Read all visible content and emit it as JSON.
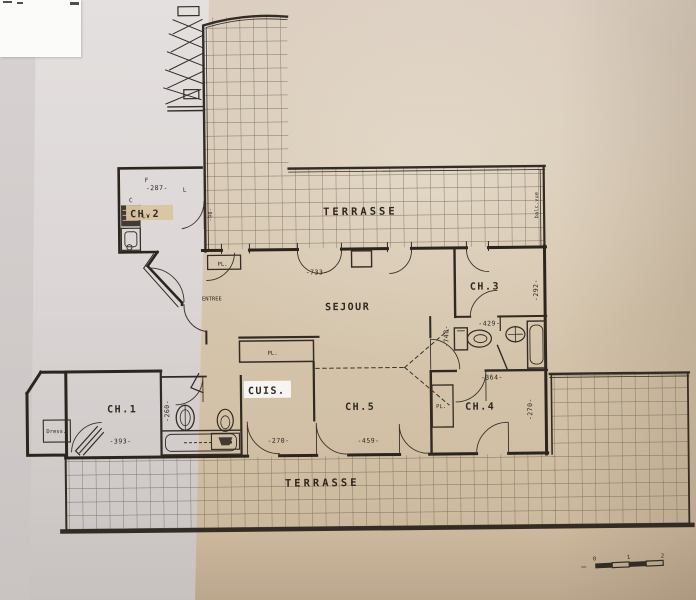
{
  "document_type": "apartment floor plan (photographed drawing)",
  "rooms": {
    "terrasse_top": "TERRASSE",
    "terrasse_bottom": "TERRASSE",
    "sejour": "SEJOUR",
    "entree": "ENTREE",
    "cuisine": "CUIS.",
    "ch1": "CH.1",
    "ch2": "CH.2",
    "ch3": "CH.3",
    "ch4": "CH.4",
    "ch5": "CH.5",
    "dressing": "Dress."
  },
  "closets": {
    "pl_entree": "PL.",
    "pl_sejour": "PL.",
    "pl_ch4": "PL."
  },
  "appliances": {
    "f": "F",
    "l": "L",
    "c": "C",
    "lv": "LV"
  },
  "dimensions": {
    "d287": "-287-",
    "d733": "-733-",
    "d292": "-292-",
    "d429": "-429-",
    "d748": "-748-",
    "d364": "-364-",
    "d270_right": "-270-",
    "d260": "-260-",
    "d393": "-393-",
    "d270_bottom": "-270-",
    "d459": "-459-",
    "d90": "-90-"
  },
  "annotations": {
    "terrace_edge_note": "balc.vue"
  },
  "scale_bar": {
    "tick0": "0",
    "tick1": "1",
    "tick2": "2"
  },
  "colors": {
    "ink": "#332c24",
    "grid_line": "#6f6454",
    "paper_warm": "#d6c7b0",
    "paper_cool": "#dcd7d6",
    "highlight_white": "#f7f5f1",
    "highlight_tan": "#d8c5a2"
  }
}
